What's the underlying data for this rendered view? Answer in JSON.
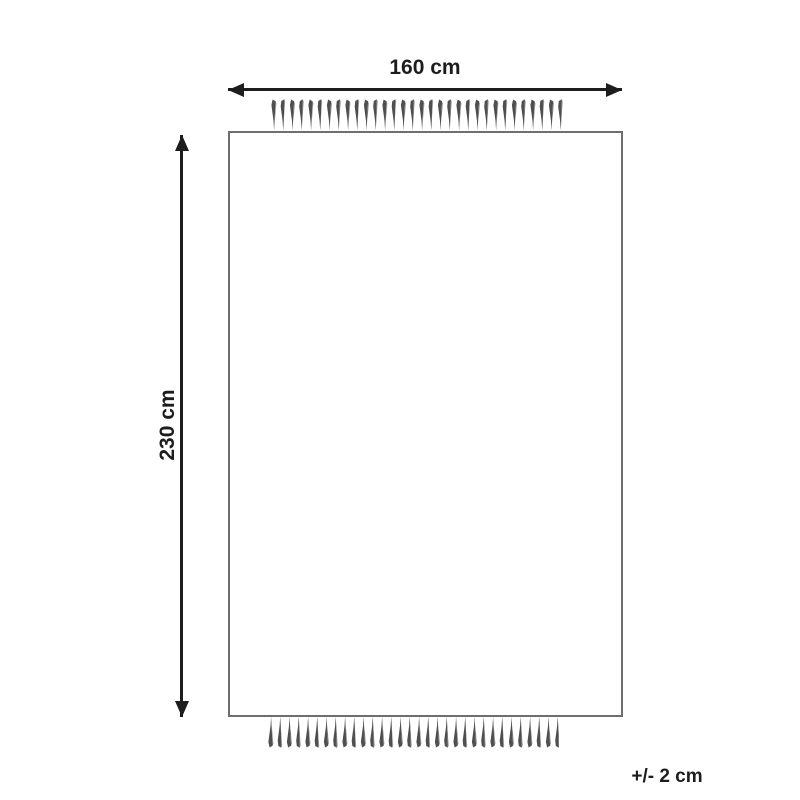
{
  "diagram": {
    "type": "rug-dimension-drawing",
    "width_label": "160 cm",
    "height_label": "230 cm",
    "tolerance_label": "+/- 2 cm"
  },
  "colors": {
    "background": "#ffffff",
    "arrow": "#1d1d1d",
    "text": "#1d1d1d",
    "outline": "#6e6e6e",
    "fringe_dark": "#4f4f4f",
    "fringe_light": "#949494"
  }
}
